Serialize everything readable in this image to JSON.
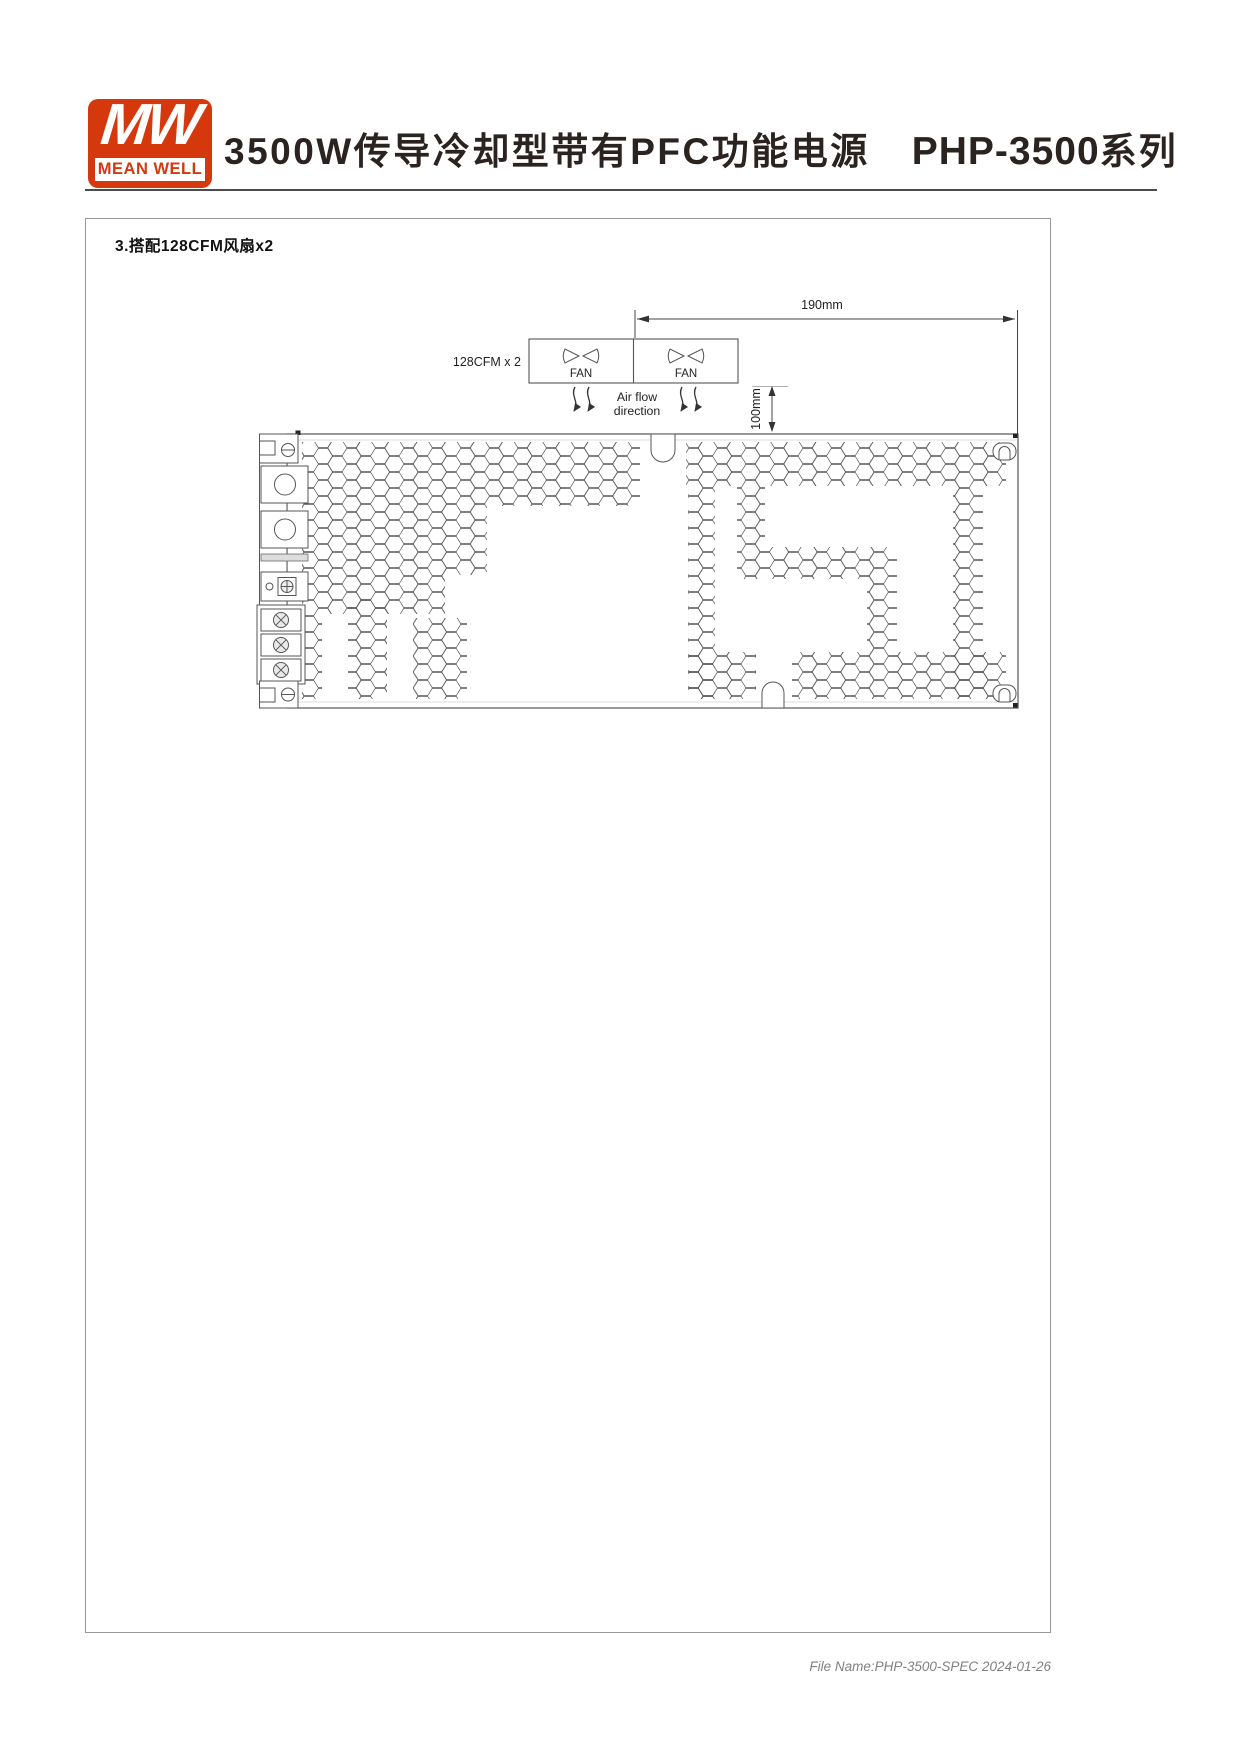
{
  "header": {
    "logo": {
      "monogram": "MW",
      "brand": "MEAN WELL"
    },
    "title": "3500W传导冷却型带有PFC功能电源",
    "series_model": "PHP-3500",
    "series_suffix": "系列"
  },
  "section": {
    "label": "3.搭配128CFM风扇x2"
  },
  "diagram": {
    "fan_caption": "128CFM x 2",
    "fan_left_label": "FAN",
    "fan_right_label": "FAN",
    "dim_width_label": "190mm",
    "dim_height_label": "100mm",
    "airflow_label_line1": "Air flow",
    "airflow_label_line2": "direction"
  },
  "footer": {
    "file_name": "File Name:PHP-3500-SPEC 2024-01-26"
  },
  "colors": {
    "brand_red": "#d6380e",
    "line": "#555555",
    "text": "#222222",
    "footer_text": "#808080"
  }
}
